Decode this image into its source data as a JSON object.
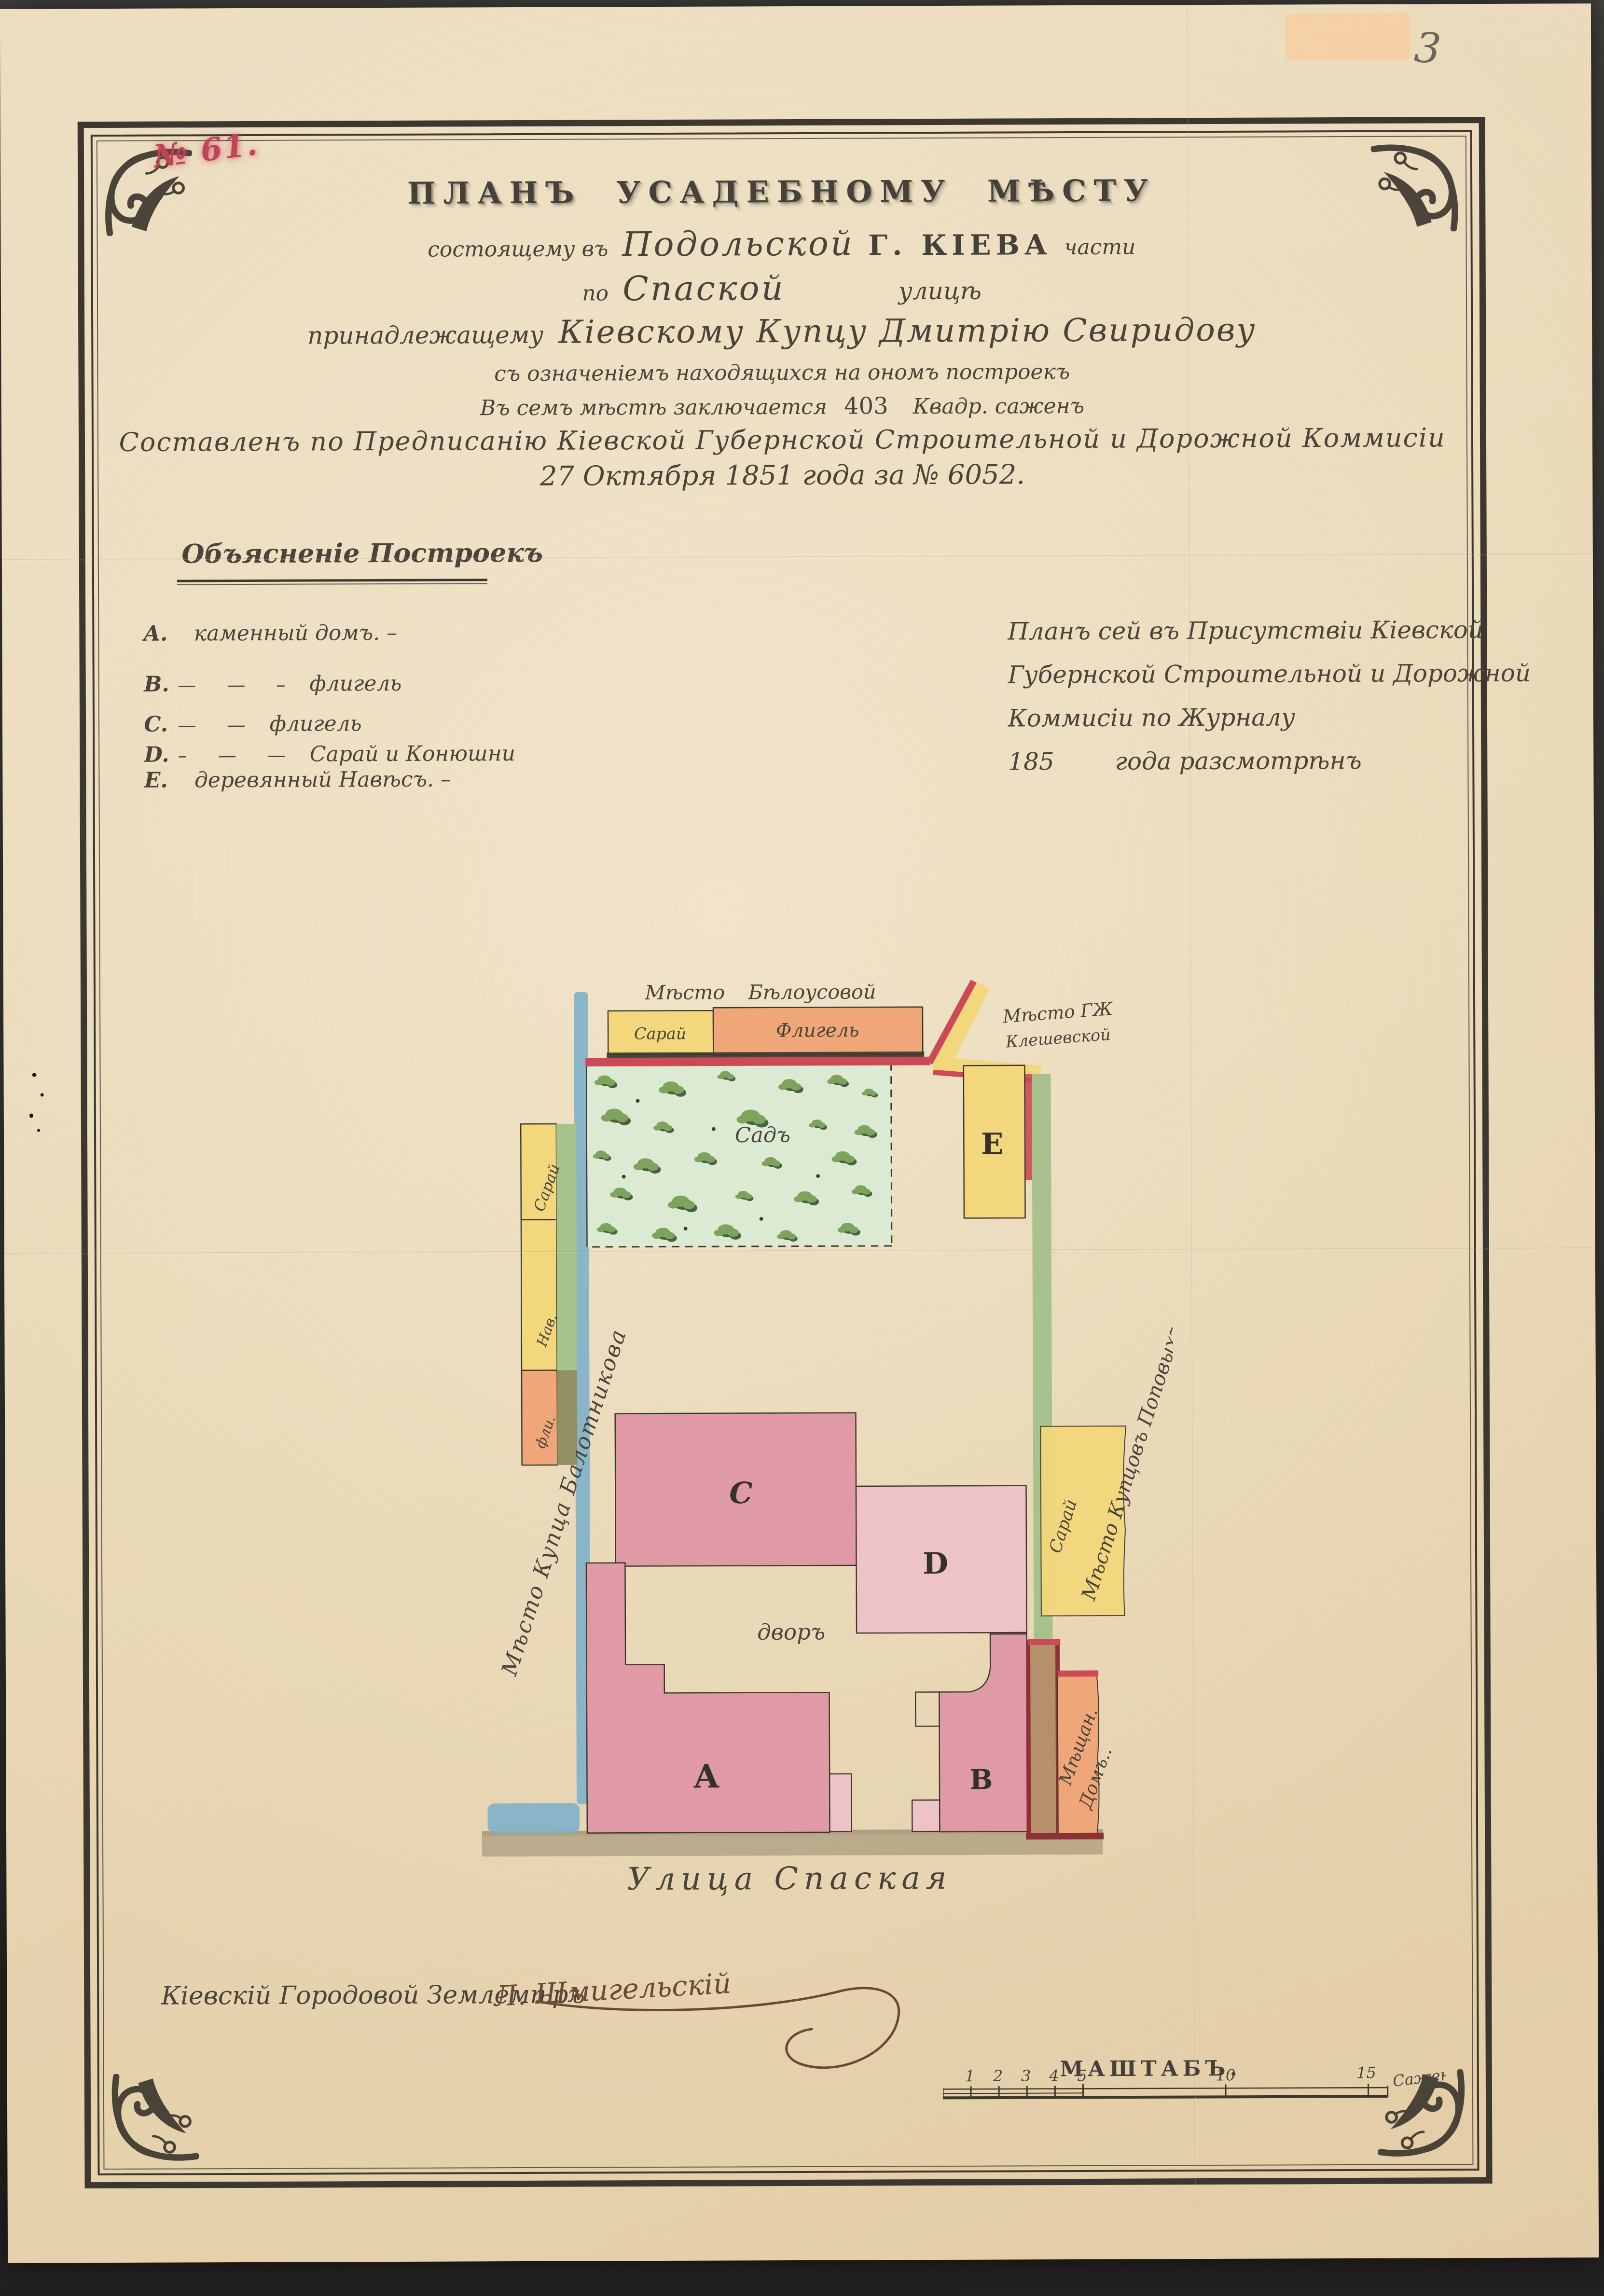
{
  "page": {
    "archival_number": "№ 61.",
    "corner_pencil_note": "3"
  },
  "title": {
    "line1": "ПЛАНЪ УСАДЕБНОМУ МѢСТУ",
    "line2_pre": "состоящему въ",
    "line2_district": "Подольской",
    "line2_city": "Г. КІЕВА",
    "line2_post": "части",
    "line3_pre": "по",
    "line3_street": "Спаской",
    "line3_post": "улицѣ",
    "line4_pre": "принадлежащему",
    "line4_owner": "Кіевскому Купцу Дмитрію Свиридову",
    "line5": "съ означеніемъ находящихся на ономъ построекъ",
    "line6_pre": "Въ семъ мѣстѣ заключается",
    "line6_area": "403",
    "line6_post": "Квадр. саженъ",
    "line7": "Составленъ по Предписанію Кіевской Губернской Строительной и Дорожной Коммисіи",
    "line8": "27 Октября 1851 года за № 6052."
  },
  "legend": {
    "heading": "Объясненіе Построекъ",
    "items": [
      {
        "letter": "A.",
        "dashes": "",
        "text": "каменный домъ. –"
      },
      {
        "letter": "B.",
        "dashes": "— — – ",
        "text": "флигель"
      },
      {
        "letter": "C.",
        "dashes": "— — ",
        "text": "флигель"
      },
      {
        "letter": "D.",
        "dashes": "– — — ",
        "text": "Сарай и Конюшни"
      },
      {
        "letter": "E.",
        "dashes": "",
        "text": "деревянный Навѣсъ. –"
      }
    ]
  },
  "approval": {
    "line1": "Планъ сей въ Присутствіи Кіевской",
    "line2": "Губернской Строительной и Дорожной",
    "line3": "Коммисіи по Журналу",
    "line4_year": "185",
    "line4_rest": "года разсмотрѣнъ"
  },
  "plan": {
    "neighbor_top": "Мѣсто Бѣлоусовой",
    "top_shed": "Сарай",
    "top_wing": "Флигель",
    "neighbor_topright_1": "Мѣсто ГЖ",
    "neighbor_topright_2": "Клешевской",
    "garden": "Садъ",
    "building_a": "A",
    "building_b": "B",
    "building_c": "C",
    "building_d": "D",
    "building_e": "E",
    "courtyard": "дворъ",
    "neighbor_left": "Мѣсто Купца Балотникова",
    "left_shed": "Сарай",
    "left_hut": "Нав.",
    "left_wing": "фли.",
    "neighbor_right": "Мѣсто Купцовъ Поповыхъ",
    "right_shed": "Сарай",
    "neighbor_bottomright_1": "Мѣщан.",
    "neighbor_bottomright_2": "Домъ..",
    "street": "Улица Спаская"
  },
  "signature": {
    "role": "Кіевскій Городовой Землемѣръ",
    "name": "Л. Шмигельскій"
  },
  "scale": {
    "title": "МАШТАБЪ.",
    "t1": "1",
    "t2": "2",
    "t3": "3",
    "t4": "4",
    "t5": "5",
    "t10": "10",
    "t15": "15",
    "unit": "Саженъ"
  },
  "colors": {
    "paper": "#e9d7b5",
    "ink": "#3d382f",
    "script-ink": "#4a443a",
    "red-ink": "#c04455",
    "boundary-red": "#cc4a57",
    "boundary-blue": "#7fb0c9",
    "boundary-green": "#a7c28c",
    "bld-pink": "#e09aa5",
    "bld-pink-light": "#edc3c8",
    "bld-yellow": "#f3d77c",
    "bld-orange": "#efa779",
    "bld-tan": "#b5906b",
    "maroon": "#8e3136",
    "garden": "#dcead4",
    "bush": "#7da35c",
    "bush-dark": "#2e4a26",
    "street": "#b3a284",
    "sepia": "#6b4a33",
    "pencil": "#55544e"
  }
}
